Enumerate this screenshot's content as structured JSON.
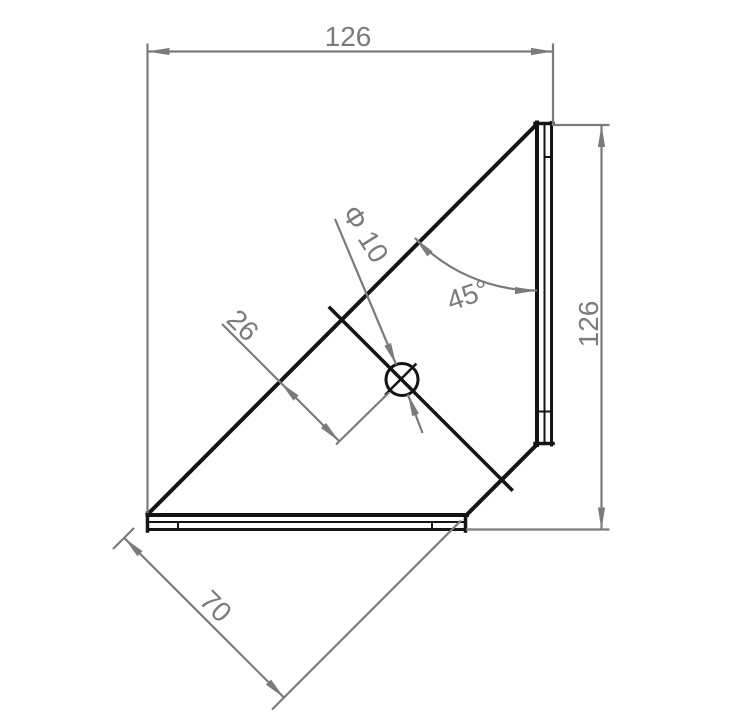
{
  "drawing": {
    "title": "corner-bracket-technical-drawing",
    "labels": {
      "top_width": "126",
      "right_height": "126",
      "chamfer_angle": "45°",
      "hole_diameter": "Φ 10",
      "hole_edge_distance": "26",
      "base_depth": "70"
    },
    "colors": {
      "dimension": "#7b7b7b",
      "part": "#141414",
      "background": "#ffffff"
    }
  }
}
